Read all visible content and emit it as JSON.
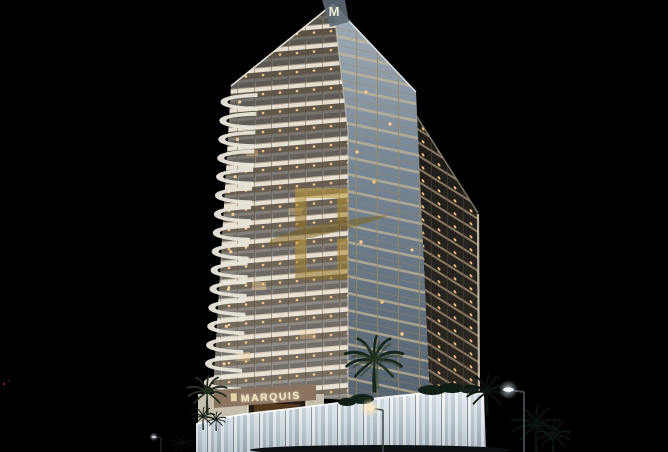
{
  "image": {
    "type": "architectural-night-render",
    "description": "Night-time 3D rendering of the Marquis high-rise residential tower with lit balconies, wavy white balcony edge, blue glass corner facade, glowing podium entrance, palm trees and street lamps against a black sky",
    "background_color": "#000000"
  },
  "building": {
    "apex_logo_letter": "M",
    "podium_sign_text": "MARQUIS",
    "sign_color": "#f3e6c4",
    "facade_front_color": "#d6cdbc",
    "facade_glass_color": "#6d7c8c",
    "mullion_gold_color": "#96845c",
    "window_light_color": "#ffcf92",
    "podium_glow_color": "#eef3f6"
  },
  "watermark": {
    "name": "gold-emblem-watermark",
    "color": "#b08f33",
    "opacity": 0.55
  },
  "scenery": {
    "palm_tree_color": "#0d1a12",
    "street_lamp_light_color": "#eef4fb"
  }
}
